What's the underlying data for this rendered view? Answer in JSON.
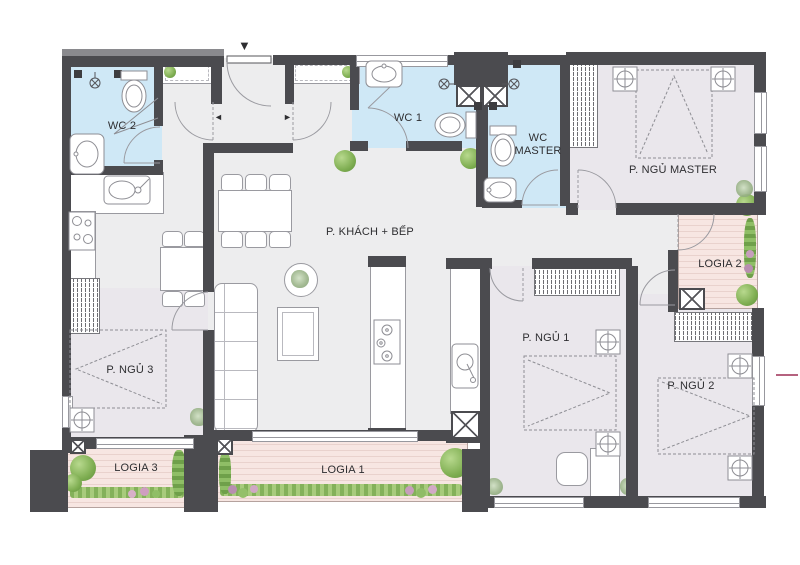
{
  "page": {
    "type": "apartment-floor-plan"
  },
  "labels": {
    "wc2": "WC 2",
    "wc1": "WC 1",
    "wc_master": "WC MASTER",
    "ngu_master": "P. NGỦ MASTER",
    "khach_bep": "P. KHÁCH + BẾP",
    "ngu1": "P. NGỦ 1",
    "ngu2": "P. NGỦ 2",
    "ngu3": "P. NGỦ 3",
    "logia1": "LOGIA 1",
    "logia2": "LOGIA 2",
    "logia3": "LOGIA 3"
  },
  "icons": {
    "entry_arrow": "▼",
    "passage_left_arrow": "◄",
    "passage_right_arrow": "►"
  },
  "colors": {
    "wall": "#4b4b4f",
    "wc_floor": "#cfe8f6",
    "bedroom_floor": "#eae7ec",
    "living_floor": "#ededee",
    "logia_deck": "#f7e6e2",
    "logia_stripe": "#e9d2cd",
    "greenery": "#86b45c",
    "outline": "#9a9aa0",
    "accent_line": "#b5627f",
    "label_text": "#2e2e31"
  }
}
